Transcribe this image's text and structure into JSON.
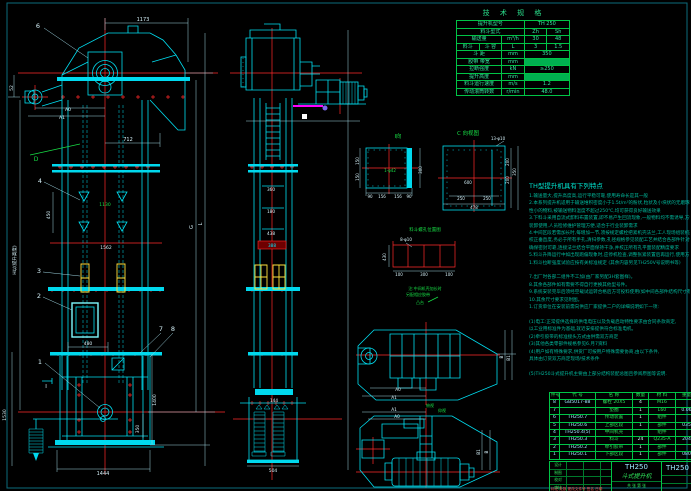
{
  "drawing": {
    "spec_table": {
      "title": "技 术 规 格",
      "rows": [
        [
          {
            "t": "提升机型号",
            "cs": 3
          },
          {
            "t": "TH 250",
            "cs": 2
          }
        ],
        [
          {
            "t": "料斗型式",
            "cs": 3
          },
          {
            "t": "Zh"
          },
          {
            "t": "Sh"
          }
        ],
        [
          {
            "t": "输送量",
            "cs": 2
          },
          {
            "t": "m³/h"
          },
          {
            "t": "30"
          },
          {
            "t": "48"
          }
        ],
        [
          {
            "t": "料斗"
          },
          {
            "t": "斗 容"
          },
          {
            "t": "L"
          },
          {
            "t": "3"
          },
          {
            "t": "1.5"
          }
        ],
        [
          {
            "t": "斗 距",
            "cs": 2
          },
          {
            "t": "mm"
          },
          {
            "t": "350",
            "cs": 2
          }
        ],
        [
          {
            "t": "胶带 带宽",
            "cs": 2
          },
          {
            "t": "mm"
          },
          {
            "t": "",
            "cs": 2,
            "hl": true
          }
        ],
        [
          {
            "t": "拉断强度",
            "cs": 2
          },
          {
            "t": "kN"
          },
          {
            "t": "≥250",
            "cs": 2
          }
        ],
        [
          {
            "t": "提升高度",
            "cs": 2
          },
          {
            "t": "mm"
          },
          {
            "t": "",
            "cs": 2,
            "hl": true
          }
        ],
        [
          {
            "t": "料斗运行速度",
            "cs": 2
          },
          {
            "t": "m/s"
          },
          {
            "t": "1.2",
            "cs": 2
          }
        ],
        [
          {
            "t": "传动滚筒转数",
            "cs": 2
          },
          {
            "t": "r/min"
          },
          {
            "t": "48.0",
            "cs": 2
          }
        ]
      ]
    },
    "notes": {
      "title": "TH型提升机具有下列特点",
      "lines": [
        "1.输送量大,提升高度高,运行平稳可靠,使用寿命长是其一般",
        "2.本系列提升机适用于输送堆积密度小于1.5t/m³的粉状,粒状及小块状的无磨琢性或磨琢",
        "  性小的物料,被输送物料温度不超过250℃,均可获得良好输送效果",
        "3.下料斗采用自流式卸料布置装置,即不易产生回流现象,一般物料均不需诱导,方便于",
        "  装卸使用,人员检修维护管理方便,适合于行业装卸需求",
        "4.中间区段若需加长时,每增加一节,须按规定螺栓把紧机壳法兰,工人现场组装机壳务必",
        "  校正垂直度,务必于所有手孔,清扫参数,孔径规格参见装配工艺并结合各部件针对性",
        "  确保密封可靠,连接法兰结合平面保持干净,并校正所有孔平面装配精度要求",
        "5.料斗升降运行中如出现跑偏现象时,应停机检查,调整张紧装置后再运行,使用方",
        "1.料斗拉断强度试验应按有关标准规定          (其余内容另见TH250V号说明书等)",
        "",
        "7.出厂时各部二组件不工加(由厂家另配3H套图样)。",
        "8.其余各部件如有需要不得自行更换其他型号件。",
        "9.系统安装完毕后须经空载试运转合格后方可投料使用(如中间各部件结构尺寸有变更按实际执行)",
        "10.其余尺寸要求见附图。",
        "1.订货单位在安装前需向供应厂家提供二户的详细说明如下一项:",
        "",
        "(1)电工:正常提供选择的供电电压以及负载启动特性要求由合同条款商定,",
        "  以工业用标准件为基础,就近安排提供符合标准电机。",
        "(2)牵引胶带的标准接头方式由供需双方商定",
        "(3)其他各类零部件规格参见6.月7资料",
        "(4)用户如有特殊要求,供货厂可按用户特殊需要协商,由以下条件,",
        "  具体由订货双方商定现场/技术条件",
        "",
        "(5)TH250斗式提升机主要由上部分结构装配总图且参阅原图等说明."
      ]
    },
    "bom": {
      "header": [
        "件号",
        "代 号",
        "名 称",
        "数量",
        "材 料",
        "重量",
        "备注"
      ],
      "rows": [
        [
          "8",
          "GB5017-88",
          "螺栓 20X5",
          "4",
          "M16",
          "",
          ""
        ],
        [
          "7",
          "",
          "垫圈",
          "1",
          "L60",
          "0.06",
          ""
        ],
        [
          "6",
          "TH250.7",
          "传动装置",
          "1",
          "组件",
          "",
          ""
        ],
        [
          "5",
          "TH250.6",
          "上部区段",
          "1",
          "部件",
          "035",
          ""
        ],
        [
          "4",
          "TH250.4(5)",
          "中间机壳",
          "",
          "组件",
          "",
          ""
        ],
        [
          "3",
          "TH250.3",
          "料斗",
          "24",
          "Q235-A",
          "204",
          ""
        ],
        [
          "2",
          "TH250.2",
          "牵引胶带",
          "1",
          "部件",
          "",
          ""
        ],
        [
          "1",
          "TH250.1",
          "下部区段",
          "1",
          "部件",
          "080",
          ""
        ]
      ]
    },
    "title_block": {
      "model": "TH250",
      "product": "斗式提升机",
      "drawing_no": "TH250",
      "rev_row": "标记 处数 更改文件号 签名 日期",
      "sig_rows": [
        "设计",
        "制图",
        "校对",
        "审核"
      ],
      "sheet_row": "共 张 第 张"
    },
    "labels": [
      {
        "t": "6",
        "x": 38,
        "y": 28,
        "c": "w",
        "s": 6.5
      },
      {
        "t": "1173",
        "x": 143,
        "y": 21,
        "c": "w",
        "s": 5
      },
      {
        "t": "52",
        "x": 13,
        "y": 88,
        "c": "w",
        "s": 4.5,
        "r": -90
      },
      {
        "t": "A0",
        "x": 68,
        "y": 111,
        "c": "w",
        "s": 4.5
      },
      {
        "t": "A1",
        "x": 62,
        "y": 119,
        "c": "w",
        "s": 4.5
      },
      {
        "t": "712",
        "x": 128,
        "y": 141,
        "c": "w",
        "s": 5
      },
      {
        "t": "D",
        "x": 36,
        "y": 161,
        "c": "g",
        "s": 6
      },
      {
        "t": "4",
        "x": 40,
        "y": 183,
        "c": "w",
        "s": 6.5
      },
      {
        "t": "450",
        "x": 50,
        "y": 215,
        "c": "w",
        "s": 4.5,
        "r": -90
      },
      {
        "t": "1130",
        "x": 105,
        "y": 206,
        "c": "g",
        "s": 4.5
      },
      {
        "t": "1562",
        "x": 106,
        "y": 249,
        "c": "w",
        "s": 4.5
      },
      {
        "t": "H以(提升高度)",
        "x": 16,
        "y": 260,
        "c": "w",
        "s": 4.5,
        "r": -90
      },
      {
        "t": "3",
        "x": 39,
        "y": 273,
        "c": "w",
        "s": 6.5
      },
      {
        "t": "2",
        "x": 39,
        "y": 298,
        "c": "w",
        "s": 6.5
      },
      {
        "t": "7",
        "x": 161,
        "y": 331,
        "c": "w",
        "s": 6.5
      },
      {
        "t": "8",
        "x": 173,
        "y": 331,
        "c": "w",
        "s": 6.5
      },
      {
        "t": "G",
        "x": 193,
        "y": 227,
        "c": "w",
        "s": 5,
        "r": -90
      },
      {
        "t": "L",
        "x": 202,
        "y": 224,
        "c": "w",
        "s": 5,
        "r": -90
      },
      {
        "t": "480",
        "x": 88,
        "y": 345,
        "c": "w",
        "s": 4.5
      },
      {
        "t": "1",
        "x": 40,
        "y": 364,
        "c": "w",
        "s": 6.5
      },
      {
        "t": "I",
        "x": 46,
        "y": 388,
        "c": "w",
        "s": 5.5
      },
      {
        "t": "350",
        "x": 139,
        "y": 429,
        "c": "w",
        "s": 4.5,
        "r": -90
      },
      {
        "t": "1400",
        "x": 156,
        "y": 400,
        "c": "w",
        "s": 4.5,
        "r": -90
      },
      {
        "t": "1530",
        "x": 6,
        "y": 415,
        "c": "w",
        "s": 4.5,
        "r": -90
      },
      {
        "t": "1444",
        "x": 103,
        "y": 475,
        "c": "w",
        "s": 5
      },
      {
        "t": "360",
        "x": 271,
        "y": 191,
        "c": "w",
        "s": 4.2
      },
      {
        "t": "180",
        "x": 271,
        "y": 213,
        "c": "w",
        "s": 4.2
      },
      {
        "t": "438",
        "x": 271,
        "y": 235,
        "c": "w",
        "s": 4.2
      },
      {
        "t": "388",
        "x": 272,
        "y": 247,
        "c": "c",
        "s": 4.2
      },
      {
        "t": "144",
        "x": 274,
        "y": 402,
        "c": "w",
        "s": 4.2
      },
      {
        "t": "504",
        "x": 273,
        "y": 472,
        "c": "w",
        "s": 4.5
      },
      {
        "t": "I向",
        "x": 398,
        "y": 138,
        "c": "g",
        "s": 5.5
      },
      {
        "t": "150",
        "x": 359,
        "y": 161,
        "c": "w",
        "s": 4,
        "r": -90
      },
      {
        "t": "150",
        "x": 359,
        "y": 177,
        "c": "w",
        "s": 4,
        "r": -90
      },
      {
        "t": "1-φ42",
        "x": 390,
        "y": 172,
        "c": "g",
        "s": 4
      },
      {
        "t": "300",
        "x": 422,
        "y": 170,
        "c": "w",
        "s": 4,
        "r": -90
      },
      {
        "t": "90",
        "x": 370,
        "y": 198,
        "c": "w",
        "s": 4
      },
      {
        "t": "156",
        "x": 382,
        "y": 198,
        "c": "w",
        "s": 4
      },
      {
        "t": "156",
        "x": 398,
        "y": 198,
        "c": "w",
        "s": 4
      },
      {
        "t": "90",
        "x": 409,
        "y": 198,
        "c": "w",
        "s": 4
      },
      {
        "t": "C 向视图",
        "x": 468,
        "y": 135,
        "c": "g",
        "s": 5.5
      },
      {
        "t": "13-φ10",
        "x": 498,
        "y": 140,
        "c": "w",
        "s": 4
      },
      {
        "t": "600",
        "x": 468,
        "y": 184,
        "c": "w",
        "s": 4
      },
      {
        "t": "250",
        "x": 461,
        "y": 200,
        "c": "w",
        "s": 4
      },
      {
        "t": "250",
        "x": 487,
        "y": 200,
        "c": "w",
        "s": 4
      },
      {
        "t": "478",
        "x": 474,
        "y": 209,
        "c": "w",
        "s": 4
      },
      {
        "t": "200",
        "x": 509,
        "y": 162,
        "c": "w",
        "s": 4,
        "r": -90
      },
      {
        "t": "200",
        "x": 509,
        "y": 180,
        "c": "w",
        "s": 4,
        "r": -90
      },
      {
        "t": "350",
        "x": 516,
        "y": 172,
        "c": "w",
        "s": 4,
        "r": -90
      },
      {
        "t": "料斗螺孔位置图",
        "x": 425,
        "y": 231,
        "c": "g",
        "s": 4.5
      },
      {
        "t": "8-φ10",
        "x": 406,
        "y": 241,
        "c": "w",
        "s": 4
      },
      {
        "t": "430",
        "x": 386,
        "y": 257,
        "c": "w",
        "s": 4,
        "r": -90
      },
      {
        "t": "100",
        "x": 399,
        "y": 276,
        "c": "w",
        "s": 4
      },
      {
        "t": "300",
        "x": 424,
        "y": 276,
        "c": "w",
        "s": 4
      },
      {
        "t": "100",
        "x": 449,
        "y": 276,
        "c": "w",
        "s": 4
      },
      {
        "t": "注:中间机壳加长时",
        "x": 425,
        "y": 290,
        "c": "g",
        "s": 4
      },
      {
        "t": "另配相应胶带",
        "x": 418,
        "y": 296,
        "c": "g",
        "s": 4
      },
      {
        "t": "凸台",
        "x": 420,
        "y": 304,
        "c": "g",
        "s": 4
      },
      {
        "t": "A0",
        "x": 398,
        "y": 391,
        "c": "w",
        "s": 4.2
      },
      {
        "t": "A1",
        "x": 394,
        "y": 399,
        "c": "w",
        "s": 4.2
      },
      {
        "t": "俯视",
        "x": 430,
        "y": 407,
        "c": "g",
        "s": 4
      },
      {
        "t": "B",
        "x": 503,
        "y": 357,
        "c": "w",
        "s": 4.2,
        "r": -90
      },
      {
        "t": "B1",
        "x": 510,
        "y": 358,
        "c": "w",
        "s": 4.2,
        "r": -90
      },
      {
        "t": "A1",
        "x": 394,
        "y": 411,
        "c": "w",
        "s": 4.2
      },
      {
        "t": "A0",
        "x": 397,
        "y": 418,
        "c": "w",
        "s": 4.2
      },
      {
        "t": "仰视",
        "x": 442,
        "y": 412,
        "c": "g",
        "s": 4
      },
      {
        "t": "B1",
        "x": 480,
        "y": 452,
        "c": "w",
        "s": 4.2,
        "r": -90
      },
      {
        "t": "B",
        "x": 488,
        "y": 452,
        "c": "w",
        "s": 4.2,
        "r": -90
      }
    ]
  }
}
